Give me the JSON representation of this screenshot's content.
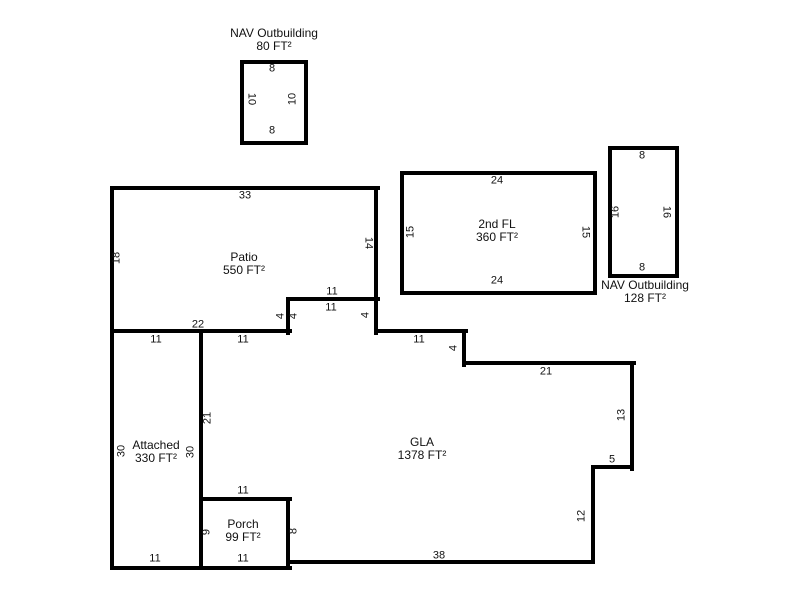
{
  "areas": {
    "nav_outbuilding_80": {
      "title": "NAV Outbuilding",
      "area": "80 FT²",
      "dim_top": "8",
      "dim_bottom": "8",
      "dim_left": "10",
      "dim_right": "10"
    },
    "patio": {
      "title": "Patio",
      "area": "550 FT²",
      "dim_top": "33",
      "dim_left": "18",
      "dim_right": "14",
      "dim_notch_top": "11",
      "dim_notch_side": "4",
      "dim_bottom": "22"
    },
    "second_fl": {
      "title": "2nd FL",
      "area": "360 FT²",
      "dim_top": "24",
      "dim_bottom": "24",
      "dim_left": "15",
      "dim_right": "15"
    },
    "nav_outbuilding_128": {
      "title": "NAV Outbuilding",
      "area": "128 FT²",
      "dim_top": "8",
      "dim_bottom": "8",
      "dim_left": "16",
      "dim_right": "16"
    },
    "attached": {
      "title": "Attached",
      "area": "330 FT²",
      "dim_top": "11",
      "dim_left": "30",
      "dim_right": "30",
      "dim_bottom": "11"
    },
    "porch": {
      "title": "Porch",
      "area": "99 FT²",
      "dim_left": "9",
      "dim_bottom": "11"
    },
    "gla": {
      "title": "GLA",
      "area": "1378 FT²",
      "dim_top_left": "11",
      "dim_notch_left": "4",
      "dim_notch_top": "11",
      "dim_notch_right": "4",
      "dim_step_top": "11",
      "dim_step_side": "4",
      "dim_upper_right": "21",
      "dim_right": "13",
      "dim_lower_step_top": "5",
      "dim_lower_step_side": "12",
      "dim_bottom": "38",
      "dim_porch_side": "8",
      "dim_left": "21",
      "dim_porch_top": "11"
    }
  }
}
